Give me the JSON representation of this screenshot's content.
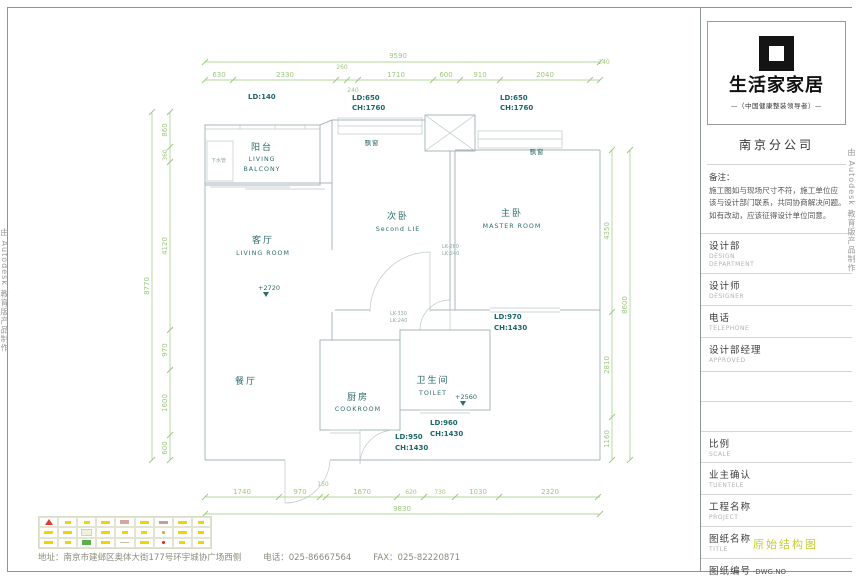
{
  "watermark": {
    "text": "由 Autodesk 教育版产品制作"
  },
  "plan": {
    "rooms": {
      "balcony": {
        "zh": "阳台",
        "en1": "LIVING",
        "en2": "BALCONY"
      },
      "living": {
        "zh": "客厅",
        "en": "LIVING ROOM",
        "level": "+2720"
      },
      "second": {
        "zh": "次卧",
        "en": "Second LIE"
      },
      "master": {
        "zh": "主卧",
        "en": "MASTER ROOM"
      },
      "dining": {
        "zh": "餐厅"
      },
      "kitchen": {
        "zh": "厨房",
        "en": "COOKROOM"
      },
      "toilet": {
        "zh": "卫生间",
        "en": "TOILET",
        "level": "+2560"
      }
    },
    "notes": {
      "drain": "下水管",
      "bay1": "飘窗",
      "bay2": "飘窗"
    },
    "openings": {
      "ld140": "LD:140",
      "w_second_l1": "LD:650",
      "w_second_l2": "CH:1760",
      "w_master_l1": "LD:650",
      "w_master_l2": "CH:1760",
      "w_corridor_l1": "LD:970",
      "w_corridor_l2": "CH:1430",
      "w_toilet_l1": "LD:960",
      "w_toilet_l2": "CH:1430",
      "w_kitchen_l1": "LD:950",
      "w_kitchen_l2": "CH:1430",
      "door_master_l1": "LK-260",
      "door_master_l2": "LK:240",
      "door_toilet_l1": "LK-330",
      "door_toilet_l2": "LK:240"
    },
    "dims": {
      "top_total": "9590",
      "top": [
        "630",
        "2330",
        "260",
        "240",
        "1710",
        "600",
        "910",
        "2040",
        "240"
      ],
      "left_total": "8770",
      "left": [
        "860",
        "360",
        "4120",
        "970",
        "1600",
        "600"
      ],
      "right_total": "8600",
      "right": [
        "4350",
        "2810",
        "1160"
      ],
      "bottom_total": "9830",
      "bottom": [
        "1740",
        "970",
        "150",
        "1670",
        "620",
        "730",
        "1030",
        "2320"
      ]
    }
  },
  "title_block": {
    "brand": "生活家家居",
    "tagline": "—（中国健康整装领导者）—",
    "branch": "南京分公司",
    "remark_title": "备注：",
    "remark_lines": [
      "施工图如与现场尺寸不符，施工单位应",
      "该与设计部门联系，共同协商解决问题。",
      "如有改动，应该征得设计单位同意。"
    ],
    "fields": {
      "dept_zh": "设计部",
      "dept_en": "DESIGN DEPARTMENT",
      "designer_zh": "设计师",
      "designer_en": "DESIGNER",
      "tel_zh": "电话",
      "tel_en": "TELEPHONE",
      "manager_zh": "设计部经理",
      "manager_en": "APPROVED",
      "scale_zh": "比例",
      "scale_en": "SCALE",
      "client_zh": "业主确认",
      "client_en": "TUENTELE",
      "project_zh": "工程名称",
      "project_en": "PROJECT",
      "sheet_zh": "图纸名称",
      "sheet_en": "TITLE",
      "sheet_value": "原始结构图",
      "no_zh": "图纸编号",
      "no_en": "·DWG.NO"
    }
  },
  "footer": {
    "address": "地址：南京市建邺区奥体大街177号环宇城协广场西侧",
    "tel": "电话：025-86667564",
    "fax": "FAX：025-82220871"
  },
  "colors": {
    "dimension_green": "#9cc87e",
    "label_teal": "#2e6b6b",
    "wall_gray": "#a9b7ba",
    "sheet_title_yellow": "#c3cf2e",
    "legend_red": "#e03a2f",
    "legend_yellow": "#f2d500",
    "legend_green": "#58b14c"
  }
}
